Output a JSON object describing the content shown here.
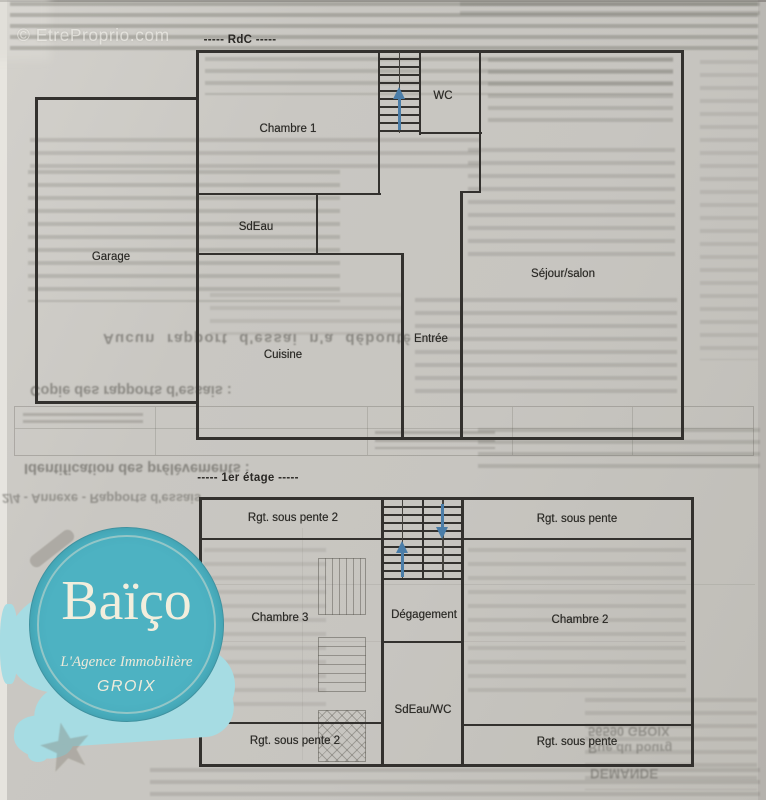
{
  "watermark": "© EtreProprio.com",
  "floors": {
    "rdc": {
      "title": "----- RdC -----",
      "rooms": {
        "chambre1": "Chambre 1",
        "wc": "WC",
        "sdeau": "SdEau",
        "garage": "Garage",
        "sejour": "Séjour/salon",
        "entree": "Entrée",
        "cuisine": "Cuisine"
      }
    },
    "etage1": {
      "title": "----- 1er étage -----",
      "rooms": {
        "rgt_sous_pente_2_haut": "Rgt. sous pente 2",
        "rgt_sous_pente_haut": "Rgt. sous pente",
        "chambre3": "Chambre 3",
        "degagement": "Dégagement",
        "chambre2": "Chambre 2",
        "sdeau_wc": "SdEau/WC",
        "rgt_sous_pente_2_bas": "Rgt. sous pente 2",
        "rgt_sous_pente_bas": "Rgt. sous pente"
      }
    }
  },
  "logo": {
    "brand": "Baïço",
    "tagline": "L'Agence Immobilière",
    "city": "GROIX"
  },
  "bleedthrough": {
    "aucun": "Aucun rapport d'essai n'a débouté",
    "copie": "Copie des rapports d'essais :",
    "identification": "Identification des prélèvements :",
    "annexe": "2/4 - Annexe - Rapports d'essais",
    "addr1": "56590 GROIX",
    "addr2": "Rue du bourg",
    "addr3": "DEMANDE"
  },
  "colors": {
    "wall": "#33312e",
    "arrow": "#4a7da8",
    "brand": "#4db2c2",
    "splash": "#a6dce3",
    "logo_text": "#f2eedd"
  }
}
